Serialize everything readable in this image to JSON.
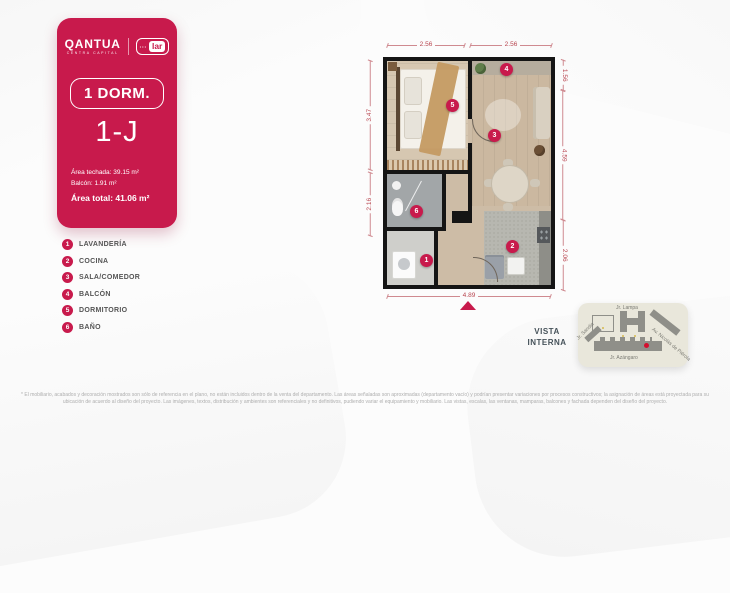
{
  "brand": {
    "name": "QANTUA",
    "tagline": "CENTRA CAPITAL",
    "partner": "lar",
    "partner_dots": "•••"
  },
  "unit": {
    "type": "1 DORM.",
    "code": "1-J",
    "area_roof_label": "Área techada:",
    "area_roof_value": "39.15 m²",
    "area_balcony_label": "Balcón:",
    "area_balcony_value": "1.91 m²",
    "area_total_label": "Área total:",
    "area_total_value": "41.06 m²"
  },
  "legend": {
    "items": [
      {
        "n": "1",
        "label": "LAVANDERÍA"
      },
      {
        "n": "2",
        "label": "COCINA"
      },
      {
        "n": "3",
        "label": "SALA/COMEDOR"
      },
      {
        "n": "4",
        "label": "BALCÓN"
      },
      {
        "n": "5",
        "label": "DORMITORIO"
      },
      {
        "n": "6",
        "label": "BAÑO"
      }
    ]
  },
  "plan": {
    "badges": [
      "1",
      "2",
      "3",
      "4",
      "5",
      "6"
    ],
    "dim_top_left": "2.56",
    "dim_top_right": "2.56",
    "dim_right_top": "1.56",
    "dim_right_mid": "4.59",
    "dim_right_bottom": "2.06",
    "dim_left_top": "3.47",
    "dim_left_bottom": "2.16",
    "dim_bottom": "4.89"
  },
  "vista": {
    "line1": "VISTA",
    "line2": "INTERNA",
    "streets": {
      "top": "Jr. Lampa",
      "bottom": "Jr. Azángaro",
      "right": "Av. Nicolás de Piérola",
      "left": "Jr. Sandia"
    }
  },
  "disclaimer": "* El mobiliario, acabados y decoración mostrados son sólo de referencia en el plano, no están incluidos dentro de la venta del departamento. Las áreas señaladas son aproximadas (departamento vacío) y podrían presentar variaciones por procesos constructivos; la asignación de áreas está proyectada para su ubicación de acuerdo al diseño del proyecto. Las imágenes, textos, distribución y ambientes son referenciales y no definitivos, pudiendo variar el equipamiento y mobiliario. Las vistas, escalas, las ventanas, mamparas, balcones y fachada dependen del diseño del proyecto.",
  "colors": {
    "brand_red": "#C81A4C",
    "dimension_red": "#B8454F",
    "title_gray": "#46525A"
  }
}
